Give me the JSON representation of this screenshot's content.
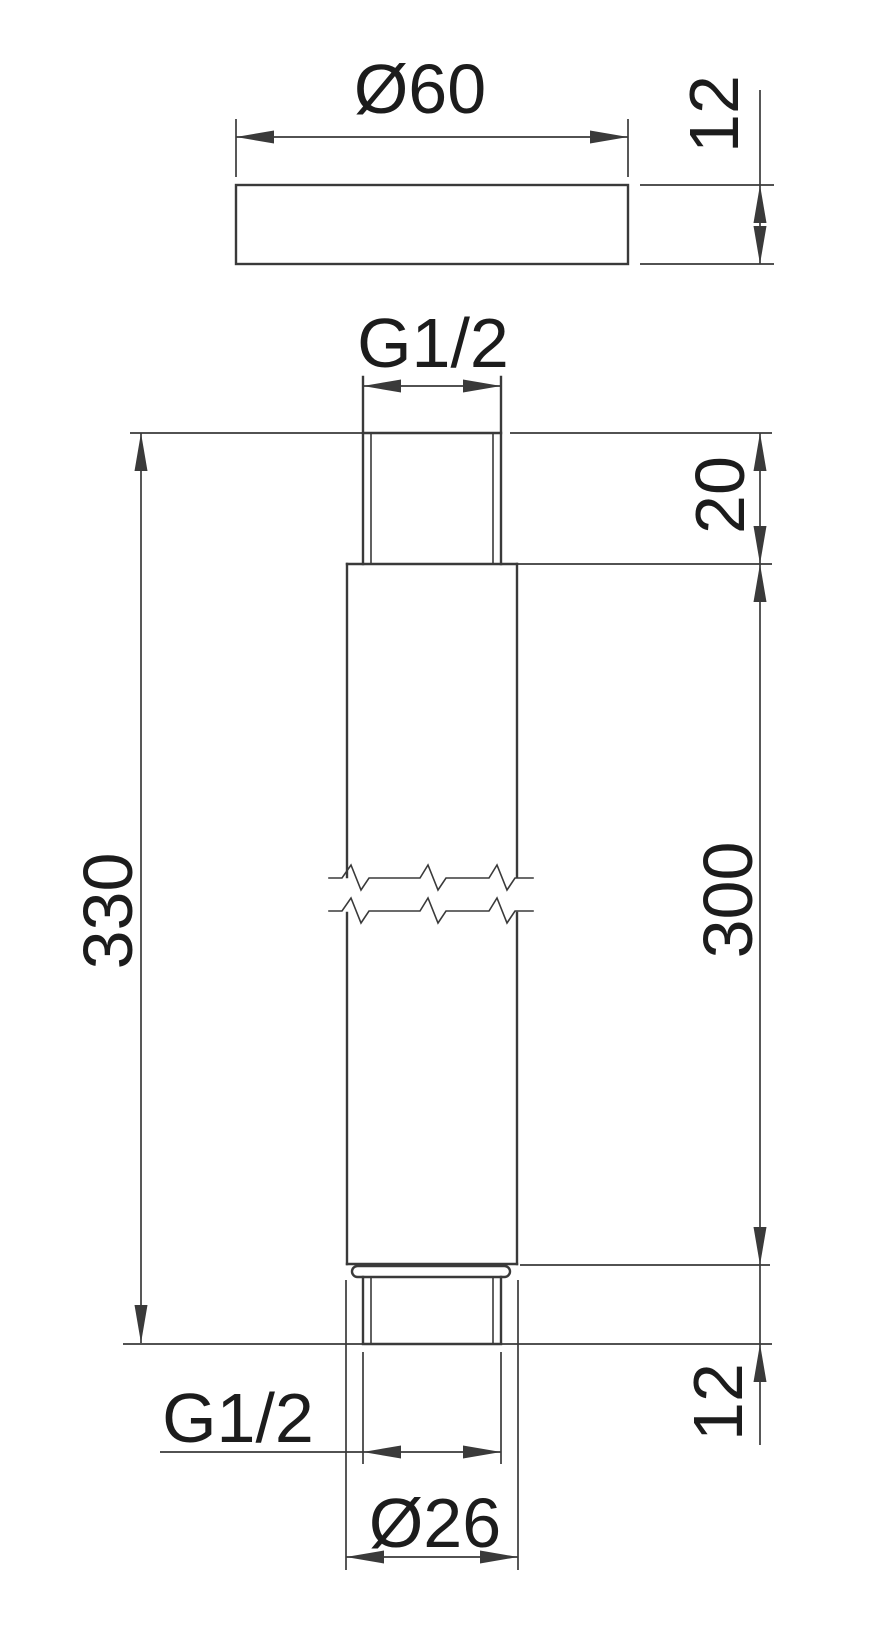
{
  "drawing": {
    "title": "threaded-tube-dimension-drawing",
    "colors": {
      "line": "#3a3a3a",
      "text": "#1c1c1c",
      "background": "#ffffff"
    },
    "top_view": {
      "diameter_label": "Ø60",
      "thickness_label": "12"
    },
    "front_view": {
      "top_thread_label": "G1/2",
      "top_thread_length_label": "20",
      "total_length_label": "330",
      "body_length_label": "300",
      "bottom_thread_length_label": "12",
      "bottom_thread_label": "G1/2",
      "bottom_diameter_label": "Ø26"
    }
  }
}
